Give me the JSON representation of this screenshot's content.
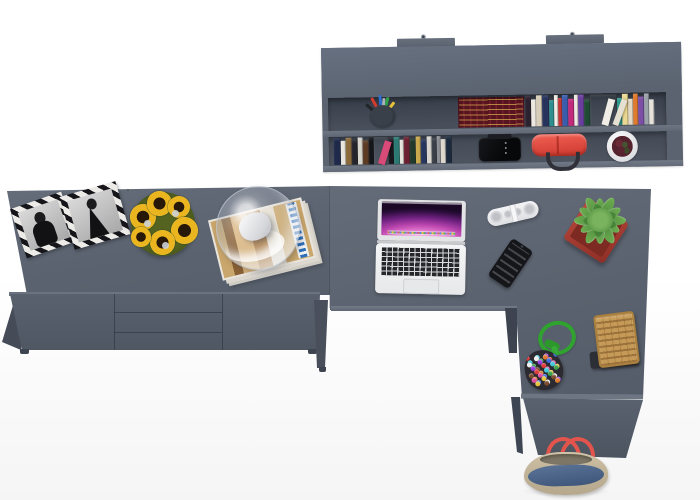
{
  "scene": {
    "description": "Top-down 3D render of a gray home-office furniture set: wall shelf with books and accessories, sideboard with picture frames, sunflowers and a glass dome lamp on magazines, an L-shaped desk with laptop, speaker, smartphone and potted plant, plus a basket, bead pouch and tote bag",
    "background": "#ffffff"
  },
  "colors": {
    "furniture_top": "#5b6370",
    "furniture_front": "#525a67",
    "furniture_side": "#454b57",
    "shelf_interior": "#424955",
    "edge_highlight": "#6e7683",
    "pot_red": "#a93a2f",
    "shelf_bag_red": "#e8453c",
    "rope_green": "#2fa22f",
    "basket_tan": "#c59a58",
    "denim_blue": "#46597c",
    "tote_beige": "#c7b89e",
    "strap_red": "#e2544c",
    "wallpaper_magenta": "#b944ae"
  },
  "shelf": {
    "maroon_books": {
      "base": "#571320",
      "stripe": "#72202c",
      "gold": "#d4a84c"
    },
    "row1_spines": [
      {
        "c": "#2b2230",
        "w": 6
      },
      {
        "c": "#ece8df",
        "w": 5,
        "h": 27
      },
      {
        "c": "#d8cdb8",
        "w": 6
      },
      {
        "c": "#27335c",
        "w": 7
      },
      {
        "c": "#2e8d8d",
        "w": 5,
        "h": 26
      },
      {
        "c": "#f0ece3",
        "w": 4
      },
      {
        "c": "#c23434",
        "w": 4,
        "h": 28
      },
      {
        "c": "#3a5cac",
        "w": 6
      },
      {
        "c": "#c22a7c",
        "w": 6,
        "h": 27
      },
      {
        "c": "#eee9e0",
        "w": 4
      },
      {
        "c": "#6a3e9e",
        "w": 6
      },
      {
        "c": "#1f4a33",
        "w": 6,
        "h": 26
      },
      {
        "c": "transparent",
        "w": 27
      },
      {
        "c": "#2b9a8e",
        "w": 5,
        "h": 27
      },
      {
        "c": "#ead892",
        "w": 6
      },
      {
        "c": "#e2d7c2",
        "w": 5,
        "h": 26
      },
      {
        "c": "#e07a2c",
        "w": 5
      },
      {
        "c": "#7c4ea6",
        "w": 6,
        "h": 28
      },
      {
        "c": "#9aa1a9",
        "w": 5
      },
      {
        "c": "#e6e2da",
        "w": 5,
        "h": 25
      },
      {
        "c": "#f0ede6",
        "w": 7,
        "lean": true,
        "x": 76,
        "r": 16
      },
      {
        "c": "#e6e0d2",
        "w": 6,
        "lean": true,
        "x": 87,
        "r": 21
      }
    ],
    "row2_spines": [
      {
        "c": "#1f2a4a",
        "w": 7
      },
      {
        "c": "#e8e5de",
        "w": 5,
        "h": 24
      },
      {
        "c": "#8a6a3a",
        "w": 6
      },
      {
        "c": "#23252b",
        "w": 6,
        "h": 25
      },
      {
        "c": "#d9d6cd",
        "w": 5
      },
      {
        "c": "#5c3a24",
        "w": 6,
        "h": 24
      },
      {
        "c": "#14161a",
        "w": 5
      },
      {
        "c": "transparent",
        "w": 15
      },
      {
        "c": "#17171c",
        "w": 5,
        "h": 25
      },
      {
        "c": "#2c7a74",
        "w": 6
      },
      {
        "c": "#e6e3db",
        "w": 4,
        "h": 24
      },
      {
        "c": "#6b2030",
        "w": 6
      },
      {
        "c": "#20392b",
        "w": 6,
        "h": 25
      },
      {
        "c": "#c9a84b",
        "w": 5
      },
      {
        "c": "#26365e",
        "w": 6,
        "h": 24
      },
      {
        "c": "#d8d5cf",
        "w": 5
      },
      {
        "c": "#3a3f47",
        "w": 5,
        "h": 25
      },
      {
        "c": "#8c8f95",
        "w": 4
      },
      {
        "c": "#ddd8ce",
        "w": 5,
        "h": 24
      },
      {
        "c": "#1c2a3e",
        "w": 6
      },
      {
        "c": "#d84a78",
        "w": 7,
        "lean": true,
        "x": 44,
        "r": 18
      }
    ]
  },
  "pens": [
    "#d23c30",
    "#2f6fd2",
    "#2fa24a",
    "#e8c23a",
    "#23252b",
    "#aab0b9"
  ],
  "beads": {
    "count": 40,
    "size": 5,
    "colors": [
      "#e03a3a",
      "#3a6ae0",
      "#e8c23a",
      "#3aa04a",
      "#9a3ae0",
      "#e07a2a",
      "#e04a9a",
      "#40c8d8",
      "#f0f0f0",
      "#7a4a2a"
    ]
  },
  "laptop": {
    "wallpaper": [
      "#ffe2f4",
      "#ee86d4",
      "#b944ae",
      "#6e2180",
      "#2e0e3e"
    ]
  },
  "flowers": {
    "petal": "#f7cf3d",
    "center": "#271807",
    "leaves": "#54631f"
  }
}
